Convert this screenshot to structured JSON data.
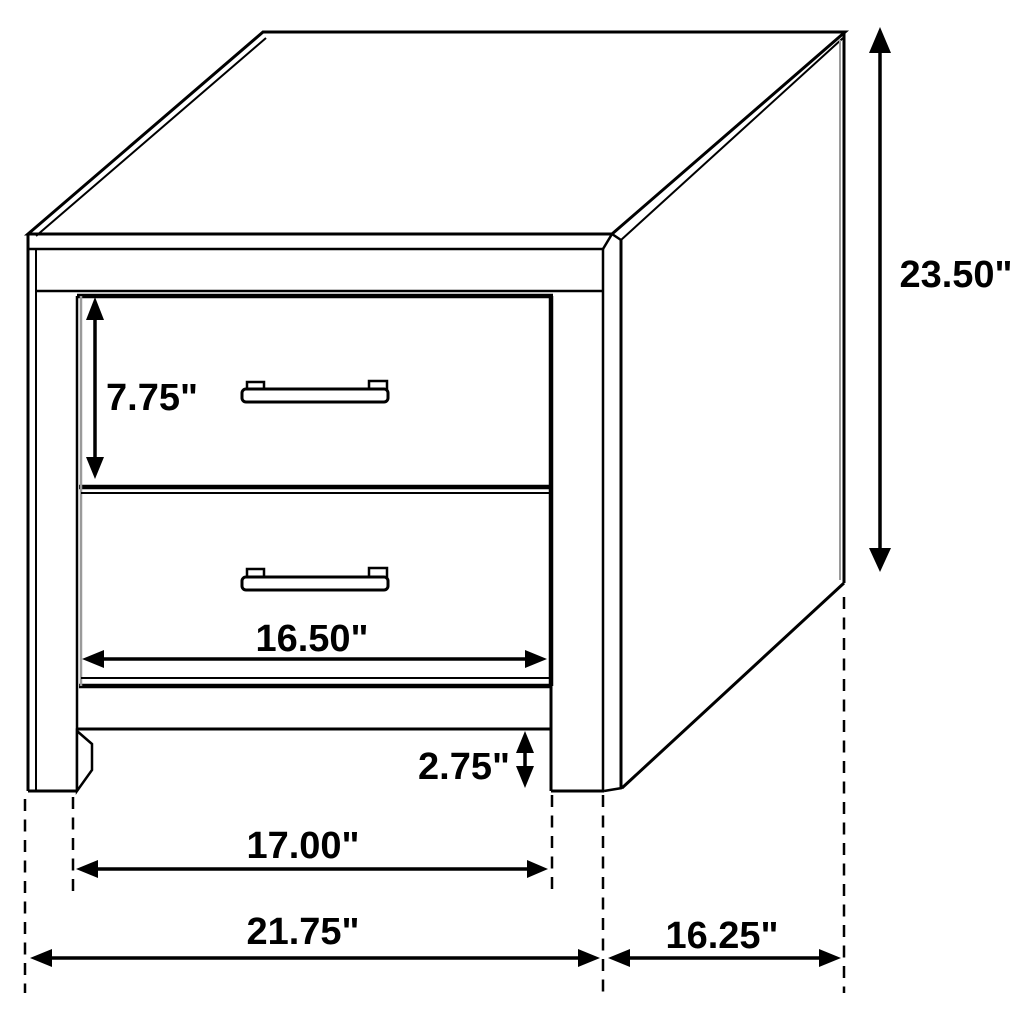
{
  "diagram": {
    "subject": "Two-drawer nightstand line drawing with dimension callouts",
    "unit": "inches",
    "line_color": "#000000",
    "background_color": "#ffffff",
    "labels": {
      "drawer_height": "7.75\"",
      "overall_height": "23.50\"",
      "drawer_width": "16.50\"",
      "foot_height": "2.75\"",
      "inner_width": "17.00\"",
      "overall_width": "21.75\"",
      "depth": "16.25\""
    }
  }
}
